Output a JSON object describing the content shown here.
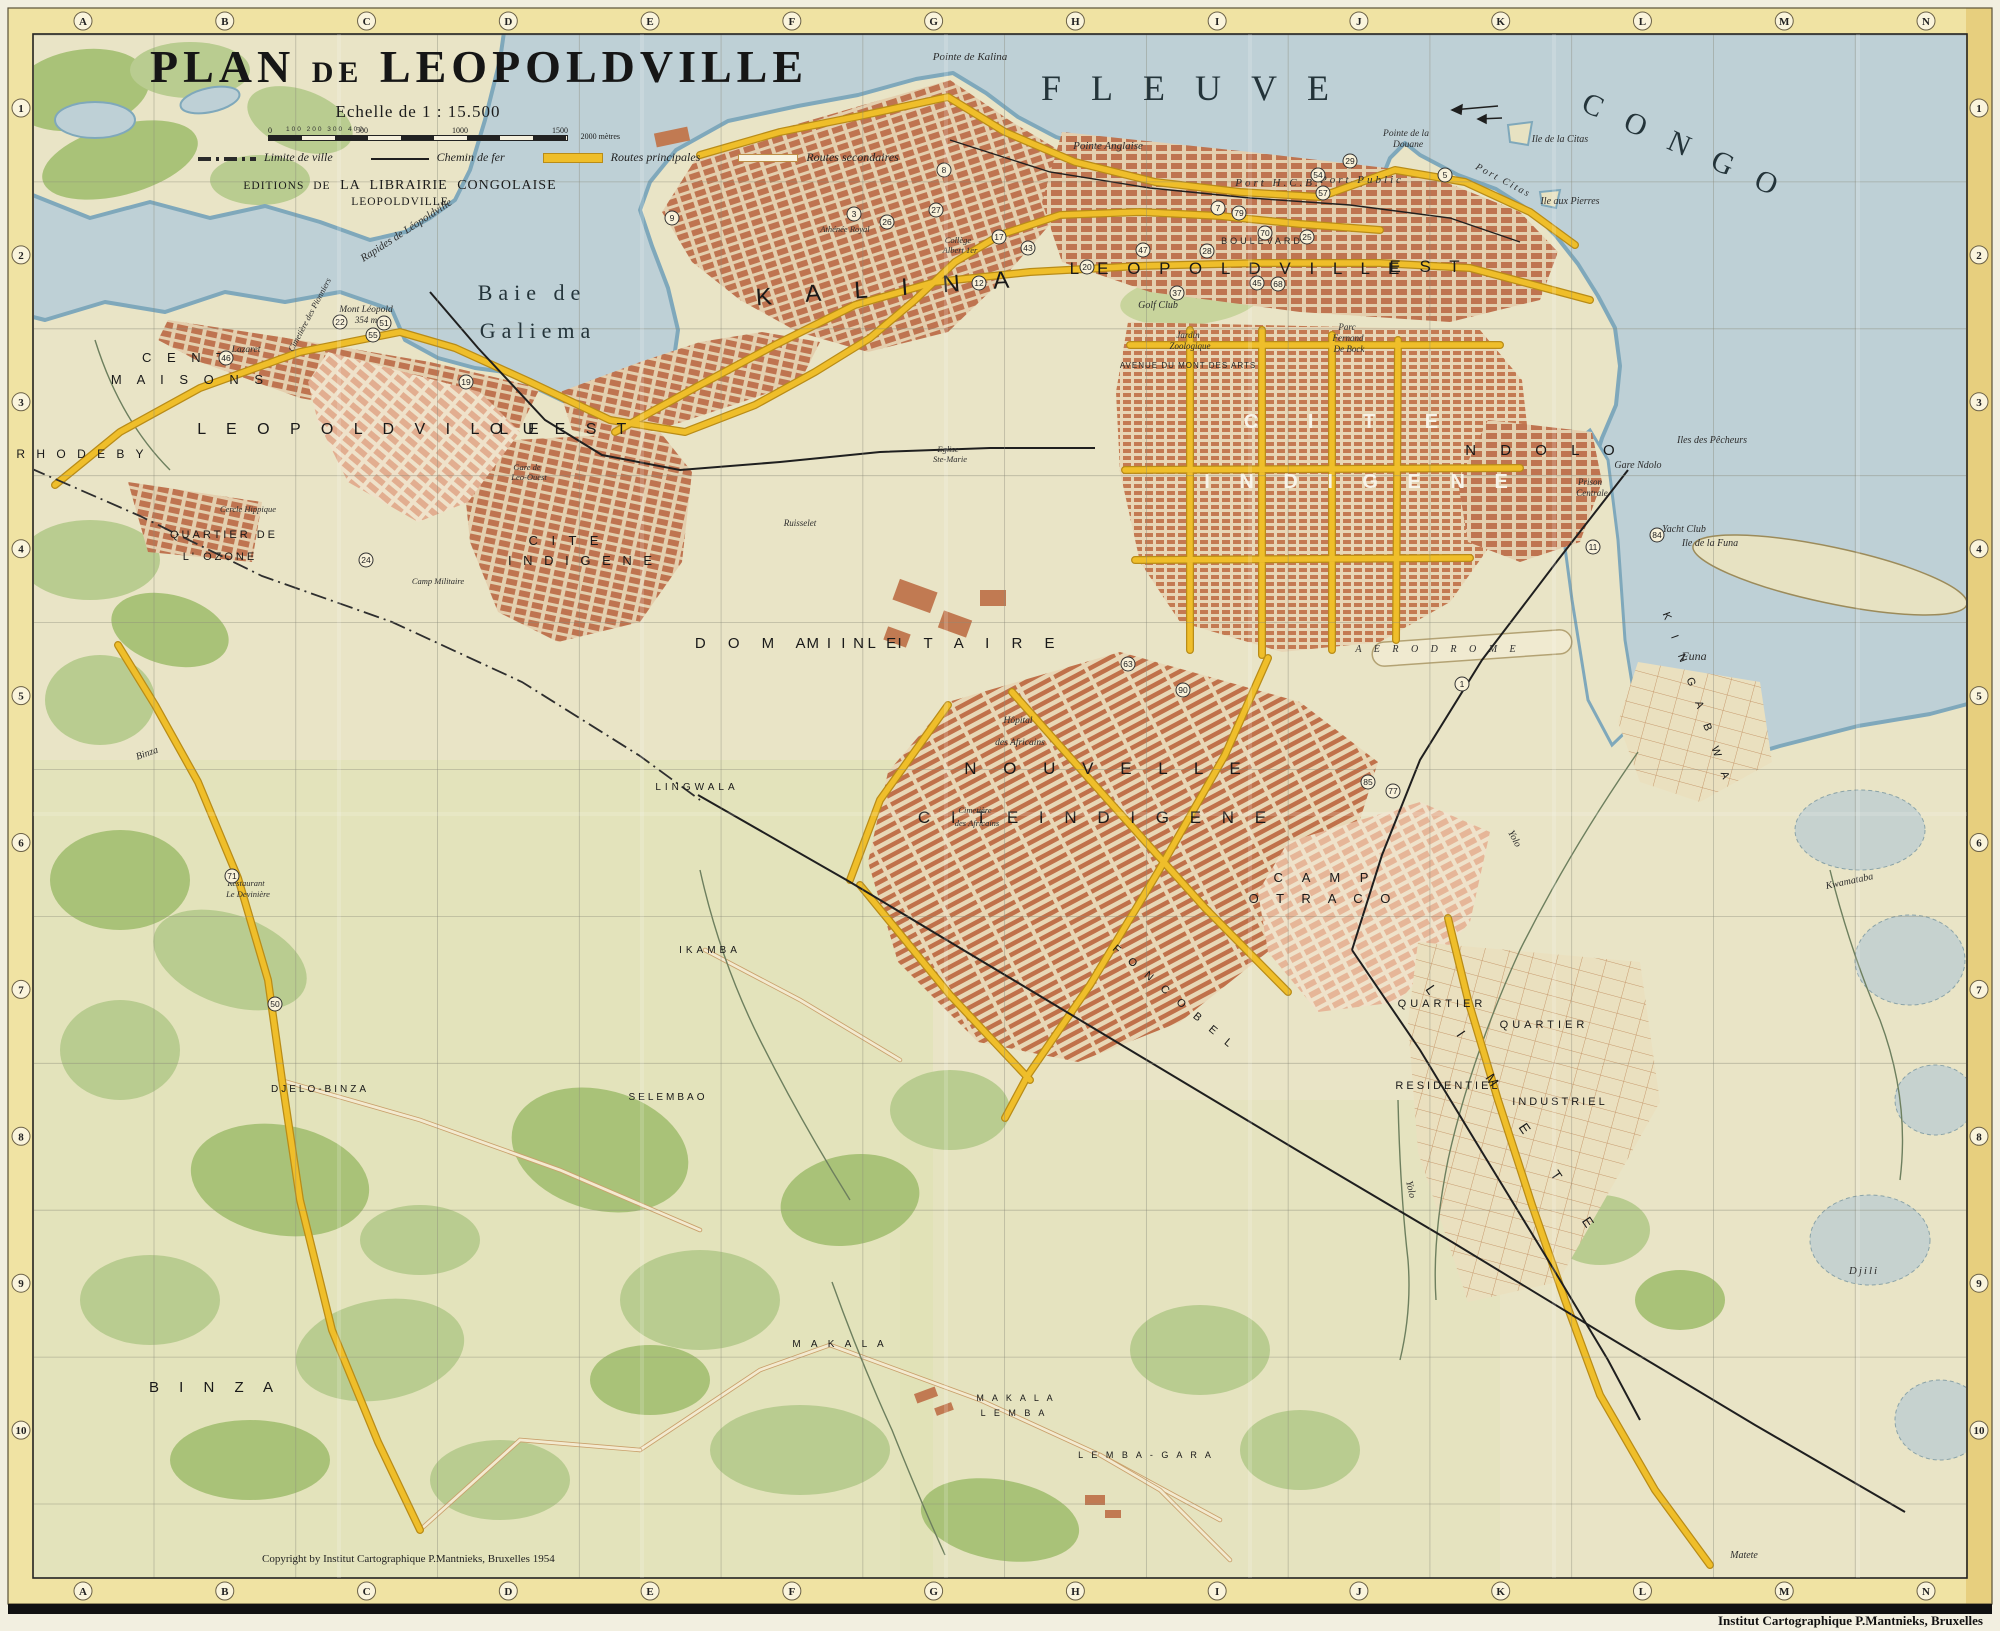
{
  "map": {
    "title": {
      "p1": "PLAN",
      "p2": "DE",
      "p3": "LEOPOLDVILLE"
    },
    "scale": {
      "title": "Echelle de 1 : 15.500",
      "minor": "100 200 300 400",
      "ticks": [
        "0",
        "500",
        "1000",
        "1500"
      ],
      "end_label": "2000 mètres"
    },
    "legend": [
      {
        "label": "Limite de ville",
        "style": "limit"
      },
      {
        "label": "Chemin de fer",
        "style": "rail"
      },
      {
        "label": "Routes principales",
        "style": "main",
        "color": "#efbe2a"
      },
      {
        "label": "Routes secondaires",
        "style": "sec",
        "color": "#f8f3e0"
      }
    ],
    "publisher": {
      "prefix": "EDITIONS DE",
      "name": "LA LIBRAIRIE CONGOLAISE",
      "city": "LEOPOLDVILLE"
    },
    "copyright": "Copyright by Institut Cartographique P.Mantnieks, Bruxelles 1954",
    "imprint": "Institut Cartographique P.Mantnieks, Bruxelles",
    "grid": {
      "columns": [
        "A",
        "B",
        "C",
        "D",
        "E",
        "F",
        "G",
        "H",
        "I",
        "J",
        "K",
        "L",
        "M",
        "N"
      ],
      "rows": [
        "1",
        "2",
        "3",
        "4",
        "5",
        "6",
        "7",
        "8",
        "9",
        "10"
      ]
    },
    "colors": {
      "water": "#bed0d6",
      "shore": "#7fa8bb",
      "land": "#e9e4c6",
      "vegetation": "#b6cb8c",
      "urban_block": "#bf7450",
      "main_road": "#efbe2a",
      "railway": "#1f1f1f",
      "border_band": "#efe19a"
    },
    "labels": [
      {
        "text": "FLEUVE",
        "x": 1200,
        "y": 100,
        "fs": 36,
        "cls": "W",
        "ls": 30
      },
      {
        "text": "CONGO",
        "x": 1688,
        "y": 158,
        "fs": 30,
        "cls": "W",
        "ls": 26,
        "rot": 24
      },
      {
        "text": "Baie de",
        "x": 532,
        "y": 300,
        "fs": 22,
        "cls": "W",
        "ls": 6
      },
      {
        "text": "Galiema",
        "x": 538,
        "y": 338,
        "fs": 22,
        "cls": "W",
        "ls": 6
      },
      {
        "text": "Pointe de Kalina",
        "x": 970,
        "y": 60,
        "fs": 11,
        "cls": "i"
      },
      {
        "text": "Pointe Anglaise",
        "x": 1108,
        "y": 149,
        "fs": 11,
        "cls": "i"
      },
      {
        "text": "Port H.C.B.",
        "x": 1278,
        "y": 186,
        "fs": 11,
        "cls": "i",
        "ls": 3
      },
      {
        "text": "Port Public",
        "x": 1362,
        "y": 183,
        "fs": 11,
        "cls": "i",
        "ls": 3
      },
      {
        "text": "Pointe de la",
        "x": 1406,
        "y": 136,
        "fs": 9.5,
        "cls": "i"
      },
      {
        "text": "Douane",
        "x": 1408,
        "y": 147,
        "fs": 9.5,
        "cls": "i"
      },
      {
        "text": "Port Citas",
        "x": 1502,
        "y": 183,
        "fs": 10,
        "cls": "i",
        "rot": 28,
        "ls": 2
      },
      {
        "text": "Ile de la Citas",
        "x": 1560,
        "y": 142,
        "fs": 10,
        "cls": "i"
      },
      {
        "text": "Ile aux Pierres",
        "x": 1570,
        "y": 204,
        "fs": 10,
        "cls": "i"
      },
      {
        "text": "Rapides de Léopoldville",
        "x": 408,
        "y": 233,
        "fs": 11,
        "cls": "i",
        "rot": -33
      },
      {
        "text": "K A L I N A",
        "x": 890,
        "y": 296,
        "fs": 24,
        "cls": "d",
        "ls": 14,
        "rot": -4
      },
      {
        "text": "L E O P O L D V I L L E",
        "x": 1238,
        "y": 274,
        "fs": 17,
        "cls": "d",
        "ls": 7
      },
      {
        "text": "E S T",
        "x": 1428,
        "y": 272,
        "fs": 17,
        "cls": "d",
        "ls": 7
      },
      {
        "text": "BOULEVARD",
        "x": 1262,
        "y": 244,
        "fs": 9,
        "cls": "r",
        "ls": 3
      },
      {
        "text": "Golf Club",
        "x": 1158,
        "y": 308,
        "fs": 10,
        "cls": "i"
      },
      {
        "text": "Jardin",
        "x": 1188,
        "y": 338,
        "fs": 9,
        "cls": "i"
      },
      {
        "text": "Zoologique",
        "x": 1190,
        "y": 349,
        "fs": 9,
        "cls": "i"
      },
      {
        "text": "Parc",
        "x": 1347,
        "y": 330,
        "fs": 9,
        "cls": "i"
      },
      {
        "text": "Fernand",
        "x": 1348,
        "y": 341,
        "fs": 9,
        "cls": "i"
      },
      {
        "text": "De Bock",
        "x": 1349,
        "y": 352,
        "fs": 9,
        "cls": "i"
      },
      {
        "text": "AVENUE DU MONT DES ARTS",
        "x": 1188,
        "y": 368,
        "fs": 8,
        "cls": "r",
        "ls": 1
      },
      {
        "text": "C I T E",
        "x": 1352,
        "y": 428,
        "fs": 20,
        "cls": "wh",
        "ls": 22
      },
      {
        "text": "I N D I G E N E",
        "x": 1362,
        "y": 488,
        "fs": 20,
        "cls": "wh",
        "ls": 12
      },
      {
        "text": "N D O L O",
        "x": 1545,
        "y": 455,
        "fs": 15,
        "cls": "d",
        "ls": 10
      },
      {
        "text": "Gare Ndolo",
        "x": 1638,
        "y": 468,
        "fs": 10,
        "cls": "i"
      },
      {
        "text": "Prison",
        "x": 1590,
        "y": 485,
        "fs": 9,
        "cls": "i"
      },
      {
        "text": "Centrale",
        "x": 1592,
        "y": 496,
        "fs": 9,
        "cls": "i"
      },
      {
        "text": "Iles des Pêcheurs",
        "x": 1712,
        "y": 443,
        "fs": 10,
        "cls": "i"
      },
      {
        "text": "Yacht Club",
        "x": 1684,
        "y": 532,
        "fs": 10,
        "cls": "i"
      },
      {
        "text": "Ile de la Funa",
        "x": 1710,
        "y": 546,
        "fs": 10,
        "cls": "i"
      },
      {
        "text": "L E O P O L D V I L L E",
        "x": 372,
        "y": 434,
        "fs": 16,
        "cls": "d",
        "ls": 8
      },
      {
        "text": "O U E S T",
        "x": 562,
        "y": 434,
        "fs": 16,
        "cls": "d",
        "ls": 8
      },
      {
        "text": "Gare de",
        "x": 527,
        "y": 470,
        "fs": 8.5,
        "cls": "i"
      },
      {
        "text": "Leo-Ouest",
        "x": 529,
        "y": 480,
        "fs": 8.5,
        "cls": "i"
      },
      {
        "text": "C E N T",
        "x": 186,
        "y": 362,
        "fs": 13,
        "cls": "d",
        "ls": 6
      },
      {
        "text": "M A I S O N S",
        "x": 190,
        "y": 384,
        "fs": 13,
        "cls": "d",
        "ls": 6
      },
      {
        "text": "R H O D E B Y",
        "x": 82,
        "y": 458,
        "fs": 12,
        "cls": "d",
        "ls": 4
      },
      {
        "text": "QUARTIER DE",
        "x": 224,
        "y": 538,
        "fs": 11,
        "cls": "d",
        "ls": 3
      },
      {
        "text": "L' OZONE",
        "x": 220,
        "y": 560,
        "fs": 11,
        "cls": "d",
        "ls": 3
      },
      {
        "text": "Cercle Hippique",
        "x": 248,
        "y": 512,
        "fs": 8.5,
        "cls": "i"
      },
      {
        "text": "C I T E",
        "x": 566,
        "y": 545,
        "fs": 13,
        "cls": "d",
        "ls": 5
      },
      {
        "text": "I N D I G E N E",
        "x": 582,
        "y": 565,
        "fs": 13,
        "cls": "d",
        "ls": 4
      },
      {
        "text": "Camp Militaire",
        "x": 438,
        "y": 584,
        "fs": 8.5,
        "cls": "i"
      },
      {
        "text": "Mont Léopold",
        "x": 366,
        "y": 312,
        "fs": 9.5,
        "cls": "i"
      },
      {
        "text": "354 m",
        "x": 366,
        "y": 323,
        "fs": 9,
        "cls": "i"
      },
      {
        "text": "Lazaret",
        "x": 246,
        "y": 352,
        "fs": 9.5,
        "cls": "i"
      },
      {
        "text": "Cimetière des Pionniers",
        "x": 312,
        "y": 316,
        "fs": 8.5,
        "cls": "i",
        "rot": -62
      },
      {
        "text": "D O M A I N E",
        "x": 800,
        "y": 648,
        "fs": 15,
        "cls": "d",
        "ls": 9
      },
      {
        "text": "M I L I T A I R E",
        "x": 935,
        "y": 648,
        "fs": 15,
        "cls": "d",
        "ls": 9
      },
      {
        "text": "Ruisselet",
        "x": 800,
        "y": 526,
        "fs": 9,
        "cls": "i"
      },
      {
        "text": "Hôpital",
        "x": 1018,
        "y": 723,
        "fs": 9.5,
        "cls": "i"
      },
      {
        "text": "des Africains",
        "x": 1020,
        "y": 745,
        "fs": 9.5,
        "cls": "i"
      },
      {
        "text": "N O U V E L L E",
        "x": 1108,
        "y": 774,
        "fs": 17,
        "cls": "d",
        "ls": 11
      },
      {
        "text": "C I T E   I N D I G E N E",
        "x": 1096,
        "y": 823,
        "fs": 17,
        "cls": "d",
        "ls": 8
      },
      {
        "text": "C A M P",
        "x": 1325,
        "y": 882,
        "fs": 13,
        "cls": "d",
        "ls": 8
      },
      {
        "text": "O T R A C O",
        "x": 1323,
        "y": 903,
        "fs": 13,
        "cls": "d",
        "ls": 7
      },
      {
        "text": "A E R O D R O M E",
        "x": 1438,
        "y": 652,
        "fs": 10,
        "cls": "i",
        "ls": 5
      },
      {
        "text": "Cimetière",
        "x": 975,
        "y": 813,
        "fs": 8.5,
        "cls": "i"
      },
      {
        "text": "des Africains",
        "x": 977,
        "y": 826,
        "fs": 8.5,
        "cls": "i"
      },
      {
        "text": "LINGWALA",
        "x": 697,
        "y": 790,
        "fs": 10,
        "cls": "d",
        "ls": 4
      },
      {
        "text": "IKAMBA",
        "x": 710,
        "y": 953,
        "fs": 10,
        "cls": "d",
        "ls": 4
      },
      {
        "text": "SELEMBAO",
        "x": 668,
        "y": 1100,
        "fs": 10,
        "cls": "d",
        "ls": 3
      },
      {
        "text": "F O N C O B E L",
        "x": 1172,
        "y": 1000,
        "fs": 11,
        "cls": "d",
        "ls": 5,
        "rot": 40
      },
      {
        "text": "Yolo",
        "x": 1512,
        "y": 840,
        "fs": 10,
        "cls": "i",
        "rot": 62
      },
      {
        "text": "Yolo",
        "x": 1408,
        "y": 1190,
        "fs": 10,
        "cls": "i",
        "rot": 78
      },
      {
        "text": "QUARTIER",
        "x": 1442,
        "y": 1007,
        "fs": 11,
        "cls": "d",
        "ls": 4
      },
      {
        "text": "RESIDENTIEL",
        "x": 1448,
        "y": 1089,
        "fs": 11,
        "cls": "d",
        "ls": 3
      },
      {
        "text": "QUARTIER",
        "x": 1544,
        "y": 1028,
        "fs": 11,
        "cls": "d",
        "ls": 4
      },
      {
        "text": "INDUSTRIEL",
        "x": 1560,
        "y": 1105,
        "fs": 11,
        "cls": "d",
        "ls": 3
      },
      {
        "text": "L I M E T E",
        "x": 1512,
        "y": 1118,
        "fs": 14,
        "cls": "d",
        "ls": 22,
        "rot": 56
      },
      {
        "text": "K I N G A B W A",
        "x": 1694,
        "y": 700,
        "fs": 11,
        "cls": "d",
        "ls": 7,
        "rot": 70
      },
      {
        "text": "Funa",
        "x": 1694,
        "y": 660,
        "fs": 12,
        "cls": "i"
      },
      {
        "text": "Kwamataba",
        "x": 1850,
        "y": 884,
        "fs": 10,
        "cls": "i",
        "rot": -12
      },
      {
        "text": "Djili",
        "x": 1864,
        "y": 1274,
        "fs": 11,
        "cls": "i",
        "ls": 2
      },
      {
        "text": "Matete",
        "x": 1744,
        "y": 1558,
        "fs": 10,
        "cls": "i"
      },
      {
        "text": "B I N Z A",
        "x": 215,
        "y": 1392,
        "fs": 15,
        "cls": "d",
        "ls": 8
      },
      {
        "text": "Binza",
        "x": 148,
        "y": 756,
        "fs": 10,
        "cls": "i",
        "rot": -20
      },
      {
        "text": "DJELO-BINZA",
        "x": 320,
        "y": 1092,
        "fs": 10,
        "cls": "d",
        "ls": 3
      },
      {
        "text": "M A K A L A",
        "x": 840,
        "y": 1347,
        "fs": 10,
        "cls": "d",
        "ls": 4
      },
      {
        "text": "M A K A L A",
        "x": 1016,
        "y": 1401,
        "fs": 9,
        "cls": "d",
        "ls": 3
      },
      {
        "text": "L E M B A",
        "x": 1014,
        "y": 1416,
        "fs": 9,
        "cls": "d",
        "ls": 3
      },
      {
        "text": "L E M B A - G A R A",
        "x": 1146,
        "y": 1458,
        "fs": 9,
        "cls": "d",
        "ls": 3
      },
      {
        "text": "Restaurant",
        "x": 246,
        "y": 886,
        "fs": 8.5,
        "cls": "i"
      },
      {
        "text": "Le Devinière",
        "x": 248,
        "y": 897,
        "fs": 8.5,
        "cls": "i"
      },
      {
        "text": "Eglise",
        "x": 948,
        "y": 452,
        "fs": 8.5,
        "cls": "i"
      },
      {
        "text": "Ste-Marie",
        "x": 950,
        "y": 462,
        "fs": 8.5,
        "cls": "i"
      },
      {
        "text": "Collège",
        "x": 958,
        "y": 243,
        "fs": 8.5,
        "cls": "i"
      },
      {
        "text": "Albert 1er",
        "x": 960,
        "y": 253,
        "fs": 8.5,
        "cls": "i"
      },
      {
        "text": "Athénée Royal",
        "x": 845,
        "y": 232,
        "fs": 8.5,
        "cls": "i"
      },
      {
        "text": "Copyright by Institut Cartographique P.Mantnieks, Bruxelles 1954",
        "x": 262,
        "y": 1562,
        "fs": 11,
        "cls": "s",
        "a": "start"
      }
    ],
    "pois": [
      {
        "n": "9",
        "x": 672,
        "y": 218
      },
      {
        "n": "8",
        "x": 944,
        "y": 170
      },
      {
        "n": "3",
        "x": 854,
        "y": 214
      },
      {
        "n": "27",
        "x": 936,
        "y": 210
      },
      {
        "n": "26",
        "x": 887,
        "y": 222
      },
      {
        "n": "17",
        "x": 999,
        "y": 237
      },
      {
        "n": "43",
        "x": 1028,
        "y": 248
      },
      {
        "n": "12",
        "x": 979,
        "y": 283
      },
      {
        "n": "20",
        "x": 1087,
        "y": 267
      },
      {
        "n": "47",
        "x": 1143,
        "y": 250
      },
      {
        "n": "37",
        "x": 1177,
        "y": 293
      },
      {
        "n": "7",
        "x": 1218,
        "y": 208
      },
      {
        "n": "79",
        "x": 1239,
        "y": 213
      },
      {
        "n": "28",
        "x": 1207,
        "y": 251
      },
      {
        "n": "70",
        "x": 1265,
        "y": 233
      },
      {
        "n": "25",
        "x": 1307,
        "y": 237
      },
      {
        "n": "45",
        "x": 1257,
        "y": 283
      },
      {
        "n": "68",
        "x": 1278,
        "y": 284
      },
      {
        "n": "22",
        "x": 340,
        "y": 322
      },
      {
        "n": "51",
        "x": 384,
        "y": 323
      },
      {
        "n": "55",
        "x": 373,
        "y": 335
      },
      {
        "n": "46",
        "x": 226,
        "y": 358
      },
      {
        "n": "19",
        "x": 466,
        "y": 382
      },
      {
        "n": "24",
        "x": 366,
        "y": 560
      },
      {
        "n": "63",
        "x": 1128,
        "y": 664
      },
      {
        "n": "90",
        "x": 1183,
        "y": 690
      },
      {
        "n": "1",
        "x": 1462,
        "y": 684
      },
      {
        "n": "77",
        "x": 1393,
        "y": 791
      },
      {
        "n": "85",
        "x": 1368,
        "y": 782
      },
      {
        "n": "11",
        "x": 1593,
        "y": 547
      },
      {
        "n": "84",
        "x": 1657,
        "y": 535
      },
      {
        "n": "29",
        "x": 1350,
        "y": 161
      },
      {
        "n": "54",
        "x": 1318,
        "y": 175
      },
      {
        "n": "5",
        "x": 1445,
        "y": 175
      },
      {
        "n": "57",
        "x": 1323,
        "y": 193
      },
      {
        "n": "71",
        "x": 232,
        "y": 876
      },
      {
        "n": "50",
        "x": 275,
        "y": 1004
      }
    ]
  }
}
